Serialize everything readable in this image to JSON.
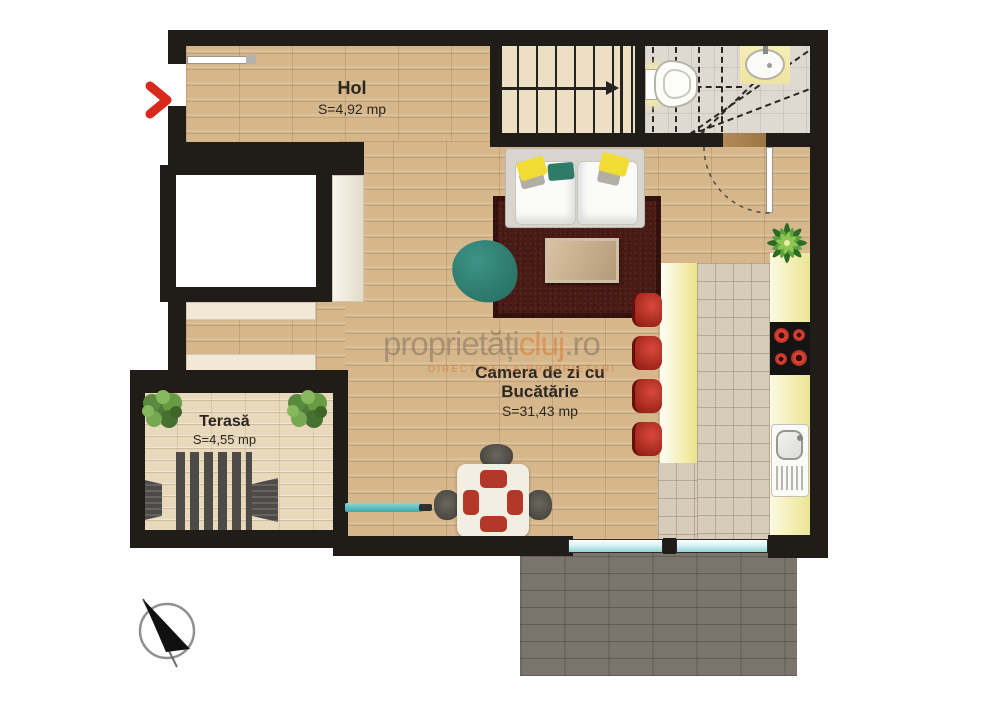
{
  "plan": {
    "rooms": {
      "hol": {
        "name": "Hol",
        "area": "S=4,92 mp"
      },
      "living": {
        "name_line1": "Camera de zi cu",
        "name_line2": "Bucătărie",
        "area": "S=31,43 mp"
      },
      "terrace": {
        "name": "Terasă",
        "area": "S=4,55 mp"
      }
    },
    "watermark": {
      "part_gray1": "proprietăți",
      "part_orange": "cluj",
      "part_gray2": ".ro",
      "tagline": "DIRECT DE LA PROPRIETARI"
    },
    "colors": {
      "wall": "#201c18",
      "wood_floor": "#d6b78c",
      "terrace_deck": "#e9d9bc",
      "rug": "#4a1a15",
      "accent_teal": "#2e7c68",
      "accent_red": "#b5372a",
      "counter_yellow": "#f3eeb4",
      "glass": "#bfe9e9",
      "entrance_arrow": "#d8291c"
    },
    "icons": [
      "entrance-arrow-icon",
      "north-arrow-icon",
      "stair-direction-arrow-icon"
    ]
  }
}
